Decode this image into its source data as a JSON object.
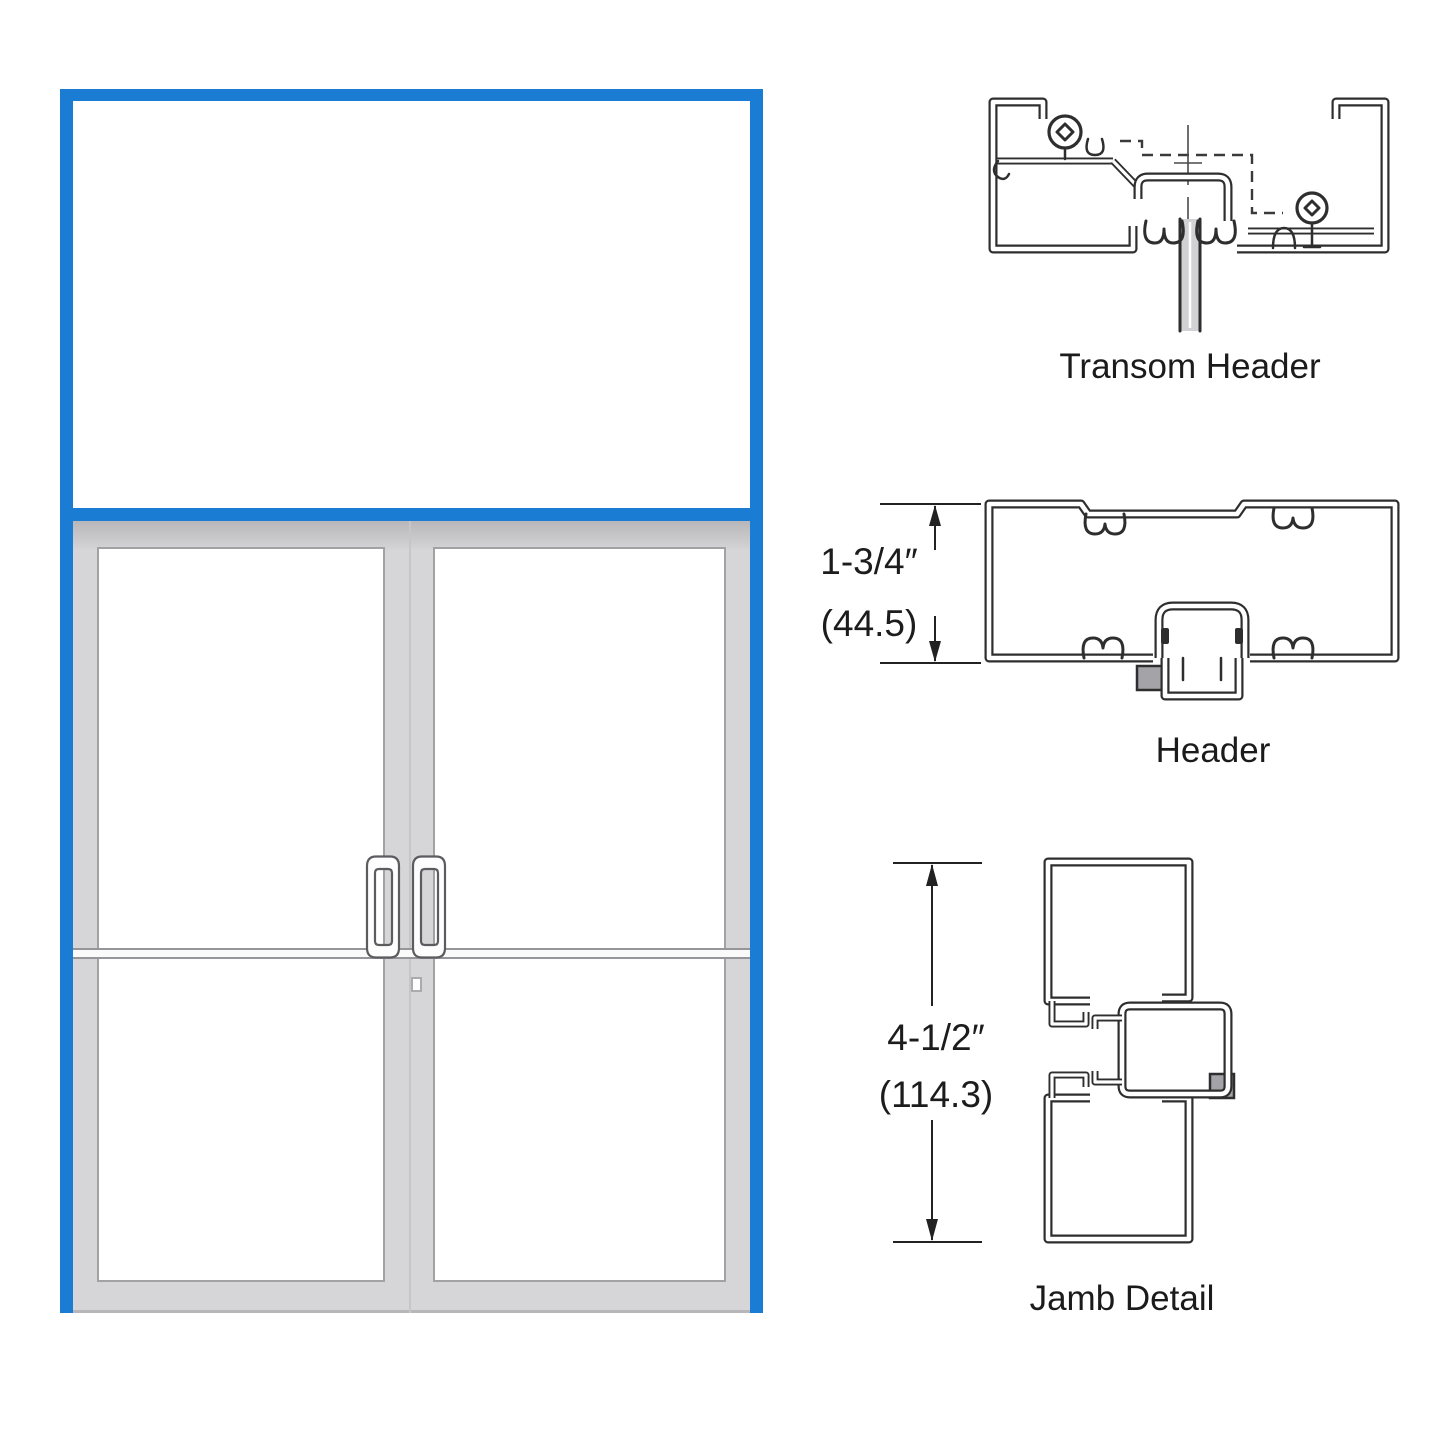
{
  "labels": {
    "transom_header": "Transom Header",
    "header": "Header",
    "jamb_detail": "Jamb Detail"
  },
  "dimensions": {
    "header": {
      "imperial": "1-3/4″",
      "metric": "(44.5)"
    },
    "jamb": {
      "imperial": "4-1/2″",
      "metric": "(114.3)"
    }
  },
  "colors": {
    "frame_blue": "#1b7cd4",
    "door_gray": "#d6d6d8",
    "door_gray_dark": "#b7b7bb",
    "glass_edge": "#a2a2a6",
    "line_dark": "#2e2e2e",
    "hardware_gray": "#a4a4a8",
    "label_text": "#1b1b1b"
  }
}
